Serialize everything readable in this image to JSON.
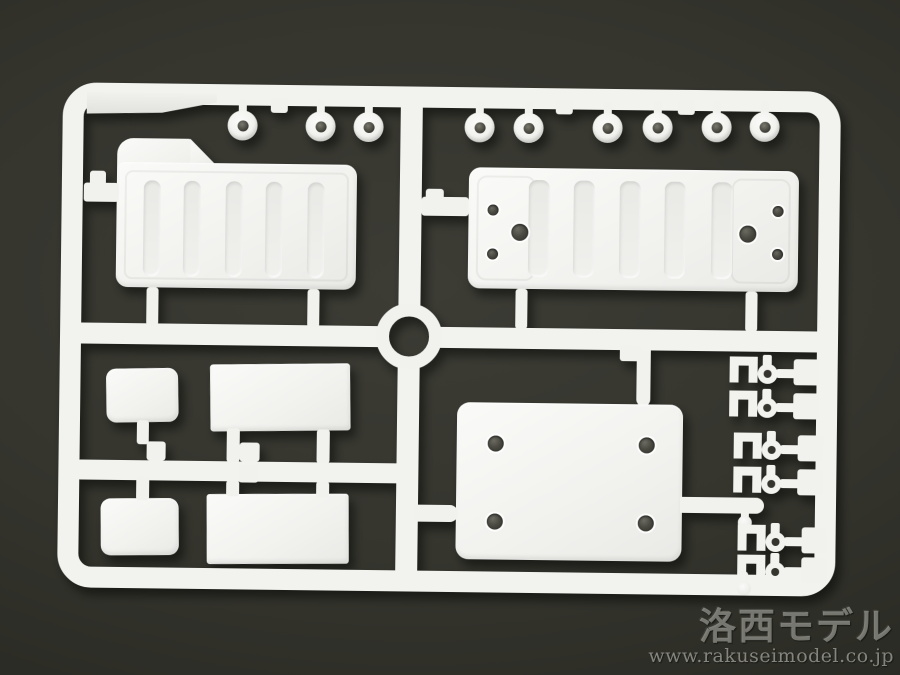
{
  "scene": {
    "description": "Photograph of a white plastic model-kit sprue (runner frame with molded parts) on a dark olive-gray background",
    "background_color": "#33332c",
    "plastic_color": "#f2f2ef",
    "shadow_color": "rgba(0,0,0,0.5)"
  },
  "watermark": {
    "logo": "洛西モデル",
    "url": "www.rakuseimodel.co.jp",
    "color": "#9a9a93"
  },
  "sprue": {
    "frame": "rounded rectangular runner frame with center cross runners and a circular ring at the junction",
    "parts": [
      {
        "name": "stepped ribbed panel",
        "qty": 1,
        "location": "upper left"
      },
      {
        "name": "ribbed mounting panel with 6 holes",
        "qty": 1,
        "location": "upper right"
      },
      {
        "name": "round bushing / grommet",
        "qty": 9,
        "location": "hanging from top rail"
      },
      {
        "name": "small rounded plate",
        "qty": 2,
        "location": "lower left"
      },
      {
        "name": "rectangular plate",
        "qty": 2,
        "location": "lower left"
      },
      {
        "name": "base plate with 4 holes",
        "qty": 1,
        "location": "lower right"
      },
      {
        "name": "fork clevis connector",
        "qty": 6,
        "location": "right column"
      },
      {
        "name": "ball pin",
        "qty": 2,
        "location": "right column"
      },
      {
        "name": "blank label tab",
        "qty": 1,
        "location": "top left corner"
      }
    ]
  }
}
